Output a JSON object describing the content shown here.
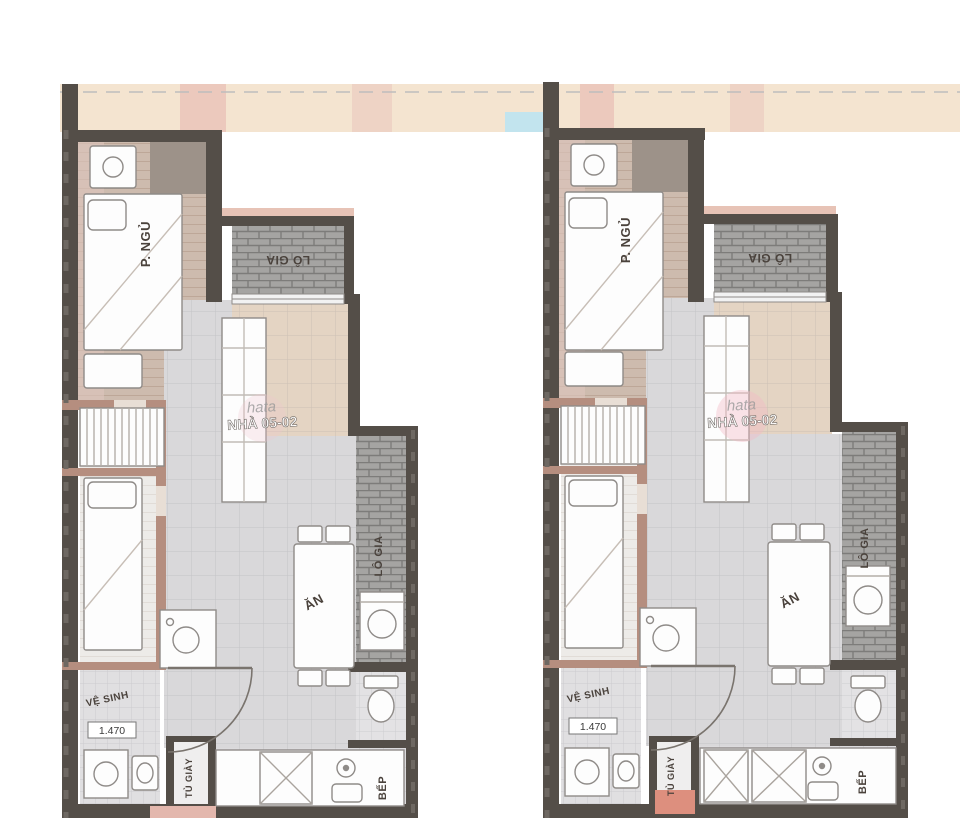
{
  "document": {
    "kind": "apartment-floor-plans",
    "plan_count": 2
  },
  "colors": {
    "wall_dark": "#544e48",
    "wall_inner_pink": "#b58e7f",
    "bedroom_floor": "#cdbbae",
    "hall_floor": "#d9d8da",
    "hall_floor_warm": "#e4d4c3",
    "loggia_hatch": "#a5a4a2",
    "band_beige": "#f4e4d0",
    "accent_pink": "#e7c3b6",
    "accent_salmon": "#dd8f7e",
    "window_blue": "#c2e4ee",
    "furniture_fill": "#fdfdfd",
    "furniture_stroke": "#8f8b88"
  },
  "left_plan": {
    "bedroom": "P. NGỦ",
    "loggia_top": "LÔ GIA",
    "loggia_side": "LÔ GIA",
    "dining": "ĂN",
    "kitchen": "BẾP",
    "bathroom": "VỆ SINH",
    "shoe_cabinet": "TỦ GIÀY",
    "dimension": "1.470",
    "watermark_brand": "hata",
    "watermark_text": "NHÀ 05-02"
  },
  "right_plan": {
    "bedroom": "P. NGỦ",
    "loggia_top": "LÔ GIA",
    "loggia_side": "LÔ GIA",
    "dining": "ĂN",
    "kitchen": "BẾP",
    "bathroom": "VỆ SINH",
    "shoe_cabinet": "TỦ GIÀY",
    "dimension": "1.470",
    "watermark_brand": "hata",
    "watermark_text": "NHÀ 05-02"
  }
}
